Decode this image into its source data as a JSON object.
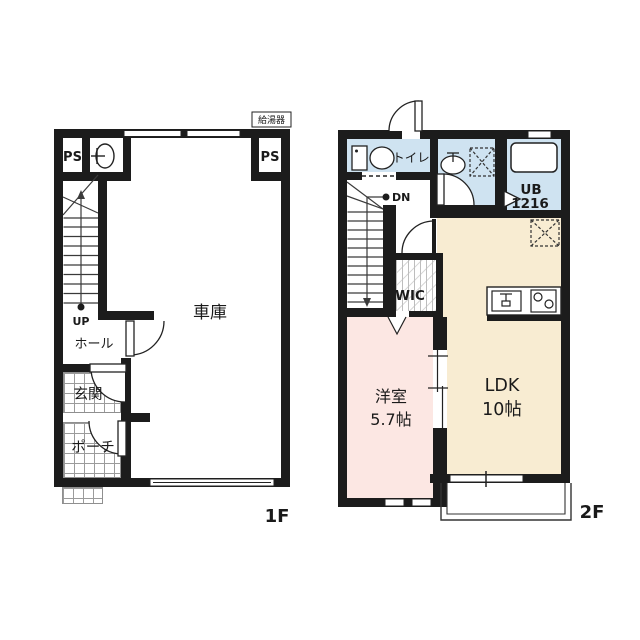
{
  "colors": {
    "wall": "#1c1c1c",
    "wet_area": "#cfe3f1",
    "ldk": "#f8ecd2",
    "bedroom": "#fce7e3"
  },
  "floor1": {
    "floor_label": "1F",
    "water_heater_label": "給湯器",
    "ps_left": "PS",
    "ps_right": "PS",
    "up_label": "UP",
    "hall": "ホール",
    "entrance": "玄関",
    "porch": "ポーチ",
    "garage": "車庫"
  },
  "floor2": {
    "floor_label": "2F",
    "toilet": "トイレ",
    "dn_label": "DN",
    "unit_bath_line1": "UB",
    "unit_bath_line2": "1216",
    "wic": "WIC",
    "western_room_name": "洋室",
    "western_room_size": "5.7帖",
    "ldk_name": "LDK",
    "ldk_size": "10帖"
  }
}
